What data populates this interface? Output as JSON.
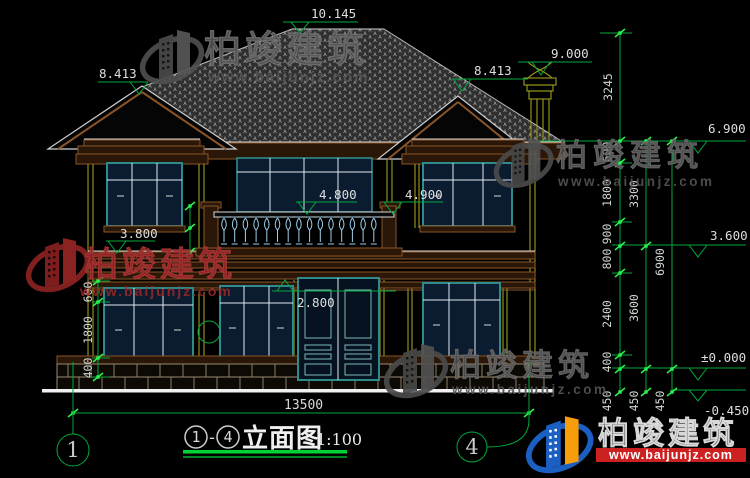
{
  "page": {
    "background": "#000000"
  },
  "title_block": {
    "grid_start": "1",
    "dash": "-",
    "grid_end": "4",
    "name": "立面图",
    "scale": "1:100"
  },
  "levels": {
    "ridge": "10.145",
    "left_gable": "8.413",
    "right_gable": "8.413",
    "chimney": "9.000",
    "eave": "6.900",
    "right_window_top": "4.900",
    "balcony": "4.800",
    "left_sill": "3.800",
    "belt": "3.600",
    "door_top": "2.800",
    "ground": "±0.000",
    "site": "-0.450"
  },
  "dimensions": {
    "overall_width": "13500",
    "right_col_inner": [
      "3245",
      "600",
      "1800",
      "900",
      "800",
      "2400",
      "400",
      "450"
    ],
    "right_col_middle": [
      "3300",
      "3600",
      "450"
    ],
    "right_col_outer": [
      "6900",
      "450"
    ],
    "left_col": [
      "600",
      "1800",
      "400"
    ]
  },
  "grid_bubbles": {
    "left": "1",
    "right": "4"
  },
  "watermark": {
    "brand": "柏竣建筑",
    "url": "www.baijunjz.com"
  },
  "logo": {
    "brand": "柏竣建筑",
    "url": "www.baijunjz.com"
  },
  "colors": {
    "dim_green": "#00a93c",
    "tick_green": "#2cf04e",
    "cad_text": "#d9d9d9",
    "frame_teal": "#2e8b8b",
    "wall_yellow": "#9c9c1e",
    "cornice_brown": "#8a5428",
    "glass_navy": "#0c1c30",
    "baluster_blue": "#9fcfe8",
    "watermark_gray": "#4d4d4d",
    "watermark_red": "#8c2222",
    "logo_blue": "#1b5fc2",
    "logo_orange": "#f59d0a",
    "logo_red_bar": "#cc2121"
  }
}
